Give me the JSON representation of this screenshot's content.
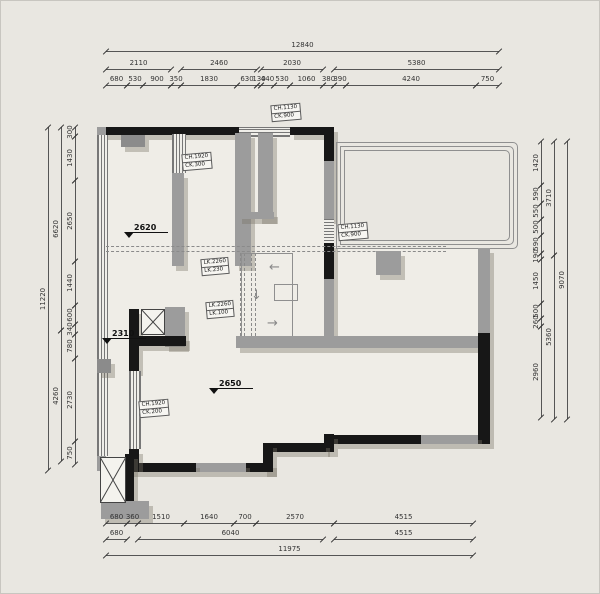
{
  "title": "floor-plan-drawing",
  "colors": {
    "background": "#e9e7e1",
    "floor": "#efede7",
    "wall_gray": "#9c9c9c",
    "wall_black": "#171717",
    "shadow": "rgba(120,115,103,0.38)",
    "dimension_text": "#333333"
  },
  "dimensions": {
    "rows": [
      {
        "name": "top-total",
        "orientation": "h",
        "pos": 50,
        "segments": [
          {
            "f": 105,
            "t": 498,
            "l": "12840"
          }
        ]
      },
      {
        "name": "top-groups",
        "orientation": "h",
        "pos": 68,
        "segments": [
          {
            "f": 105,
            "t": 170,
            "l": "2110"
          },
          {
            "f": 180,
            "t": 256,
            "l": "2460"
          },
          {
            "f": 260,
            "t": 322,
            "l": "2030"
          },
          {
            "f": 333,
            "t": 498,
            "l": "5380"
          }
        ]
      },
      {
        "name": "top-detail",
        "orientation": "h",
        "pos": 84,
        "segments": [
          {
            "f": 105,
            "t": 126,
            "l": "680"
          },
          {
            "f": 126,
            "t": 142,
            "l": "530"
          },
          {
            "f": 142,
            "t": 170,
            "l": "900"
          },
          {
            "f": 170,
            "t": 180,
            "l": "350"
          },
          {
            "f": 180,
            "t": 236,
            "l": "1830"
          },
          {
            "f": 236,
            "t": 256,
            "l": "630"
          },
          {
            "f": 256,
            "t": 260,
            "l": "130"
          },
          {
            "f": 260,
            "t": 273,
            "l": "440"
          },
          {
            "f": 273,
            "t": 289,
            "l": "530"
          },
          {
            "f": 289,
            "t": 322,
            "l": "1060"
          },
          {
            "f": 322,
            "t": 333,
            "l": "380"
          },
          {
            "f": 333,
            "t": 345,
            "l": "390"
          },
          {
            "f": 345,
            "t": 475,
            "l": "4240"
          },
          {
            "f": 475,
            "t": 498,
            "l": "750"
          }
        ]
      },
      {
        "name": "left-outer",
        "orientation": "v",
        "pos": 47,
        "segments": [
          {
            "f": 126,
            "t": 469,
            "l": "11220"
          }
        ]
      },
      {
        "name": "left-mid",
        "orientation": "v",
        "pos": 60,
        "segments": [
          {
            "f": 126,
            "t": 329,
            "l": "6620"
          },
          {
            "f": 329,
            "t": 460,
            "l": "4260"
          }
        ]
      },
      {
        "name": "left-inner",
        "orientation": "v",
        "pos": 74,
        "segments": [
          {
            "f": 126,
            "t": 135,
            "l": "300"
          },
          {
            "f": 135,
            "t": 179,
            "l": "1430"
          },
          {
            "f": 179,
            "t": 260,
            "l": "2650"
          },
          {
            "f": 260,
            "t": 304,
            "l": "1440"
          },
          {
            "f": 304,
            "t": 323,
            "l": "600"
          },
          {
            "f": 323,
            "t": 333,
            "l": "340"
          },
          {
            "f": 333,
            "t": 357,
            "l": "780"
          },
          {
            "f": 357,
            "t": 440,
            "l": "2730"
          },
          {
            "f": 440,
            "t": 463,
            "l": "750"
          }
        ]
      },
      {
        "name": "right-inner",
        "orientation": "v",
        "pos": 540,
        "segments": [
          {
            "f": 140,
            "t": 184,
            "l": "1420"
          },
          {
            "f": 184,
            "t": 202,
            "l": "590"
          },
          {
            "f": 202,
            "t": 218,
            "l": "550"
          },
          {
            "f": 218,
            "t": 234,
            "l": "500"
          },
          {
            "f": 234,
            "t": 252,
            "l": "590"
          },
          {
            "f": 252,
            "t": 258,
            "l": "190"
          },
          {
            "f": 258,
            "t": 302,
            "l": "1450"
          },
          {
            "f": 302,
            "t": 317,
            "l": "500"
          },
          {
            "f": 317,
            "t": 325,
            "l": "260"
          },
          {
            "f": 325,
            "t": 416,
            "l": "2960"
          }
        ]
      },
      {
        "name": "right-mid",
        "orientation": "v",
        "pos": 553,
        "segments": [
          {
            "f": 140,
            "t": 254,
            "l": "3710"
          },
          {
            "f": 254,
            "t": 418,
            "l": "5360"
          }
        ]
      },
      {
        "name": "right-outer",
        "orientation": "v",
        "pos": 566,
        "segments": [
          {
            "f": 140,
            "t": 418,
            "l": "9070"
          }
        ]
      },
      {
        "name": "bottom-detail",
        "orientation": "h",
        "pos": 522,
        "segments": [
          {
            "f": 105,
            "t": 126,
            "l": "680"
          },
          {
            "f": 126,
            "t": 137,
            "l": "360"
          },
          {
            "f": 137,
            "t": 183,
            "l": "1510"
          },
          {
            "f": 183,
            "t": 233,
            "l": "1640"
          },
          {
            "f": 233,
            "t": 255,
            "l": "700"
          },
          {
            "f": 255,
            "t": 333,
            "l": "2570"
          },
          {
            "f": 333,
            "t": 472,
            "l": "4515"
          }
        ]
      },
      {
        "name": "bottom-mid",
        "orientation": "h",
        "pos": 538,
        "segments": [
          {
            "f": 105,
            "t": 126,
            "l": "680"
          },
          {
            "f": 137,
            "t": 322,
            "l": "6040"
          },
          {
            "f": 333,
            "t": 472,
            "l": "4515"
          }
        ]
      },
      {
        "name": "bottom-total",
        "orientation": "h",
        "pos": 554,
        "segments": [
          {
            "f": 105,
            "t": 472,
            "l": "11975"
          }
        ]
      }
    ]
  },
  "plan_labels": [
    {
      "name": "window-spec-label",
      "x": 270,
      "y": 103,
      "lines": [
        "CH.1130",
        "CK.900"
      ]
    },
    {
      "name": "window-spec-label",
      "x": 181,
      "y": 152,
      "lines": [
        "CH.1920",
        "CK.300"
      ]
    },
    {
      "name": "window-spec-label",
      "x": 337,
      "y": 222,
      "lines": [
        "CH.1130",
        "CK.900"
      ]
    },
    {
      "name": "beam-spec-label",
      "x": 200,
      "y": 257,
      "lines": [
        "LK.2260",
        "LK.230"
      ]
    },
    {
      "name": "beam-spec-label",
      "x": 205,
      "y": 300,
      "lines": [
        "LK.2260",
        "LK.100"
      ]
    },
    {
      "name": "window-spec-label",
      "x": 138,
      "y": 399,
      "lines": [
        "CH.1920",
        "CK.200"
      ]
    }
  ],
  "level_markers": [
    {
      "name": "level-marker",
      "x": 125,
      "y": 221,
      "value": "2620"
    },
    {
      "name": "level-marker",
      "x": 103,
      "y": 327,
      "value": "2310"
    },
    {
      "name": "level-marker",
      "x": 210,
      "y": 377,
      "value": "2650"
    }
  ],
  "arrows": [
    {
      "name": "arrow-left-icon",
      "x": 268,
      "y": 260,
      "glyph": "←"
    },
    {
      "name": "arrow-down-icon",
      "x": 250,
      "y": 288,
      "glyph": "↓"
    },
    {
      "name": "arrow-right-icon",
      "x": 266,
      "y": 316,
      "glyph": "→"
    }
  ]
}
